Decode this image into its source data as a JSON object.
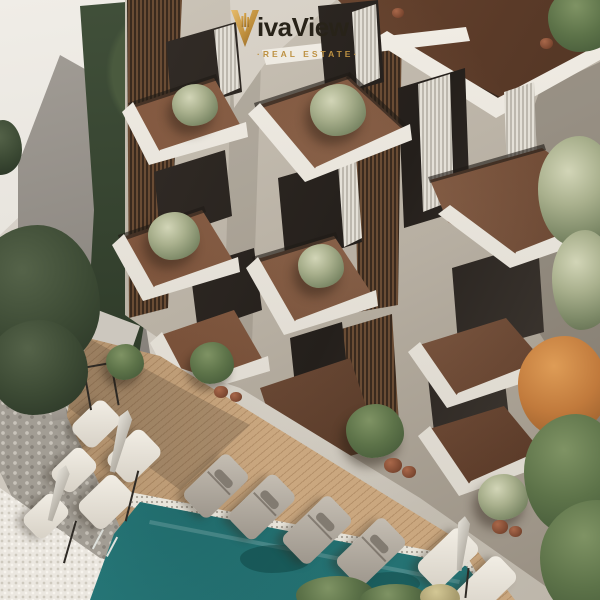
{
  "brand": {
    "wordmark": "ivaView",
    "mark_letter": "V",
    "tagline": "·REAL ESTATE·"
  },
  "icons": {
    "logo_mark_icon": "stylized gold letter V with building skyline inside"
  },
  "palette": {
    "gold": "#c2923c",
    "goldlight": "#e3b766",
    "golddark": "#8f6426",
    "ink": "#282319",
    "concrete": "#c4bcb0",
    "concretedark": "#9a9185",
    "fascia": "#eae6de",
    "terracotta": "#7c5238",
    "slatwood": "#5f4530",
    "deck": "#c5a27c",
    "pool": "#2f8c8d",
    "coping": "#e8e4da",
    "hedge": "#38452f",
    "treedark": "#3f4c37",
    "treegreen": "#53684a",
    "treeolive": "#9aa485",
    "treeorange": "#c47c3e",
    "cushionwhite": "#e9e4da",
    "cushiongray": "#aaa49a",
    "curtain": "#d9d5cc",
    "glass": "#322d29",
    "stone": "#a19c93",
    "pebble": "#eae6df"
  },
  "scene": {
    "elements": [
      "modern apartment building with stacked cantilevered balconies",
      "olive trees in pots on balcony terraces",
      "brown terracotta balcony floors and roof terrace",
      "wood slat screens and glass doors with white curtains",
      "white boundary wall and tall green hedge",
      "teal swimming pool with ladder",
      "timber pool deck",
      "four gray sun loungers by the pool",
      "white daybeds and closed umbrellas",
      "stone retaining wall and white pebble border",
      "green and autumn-orange trees"
    ]
  }
}
